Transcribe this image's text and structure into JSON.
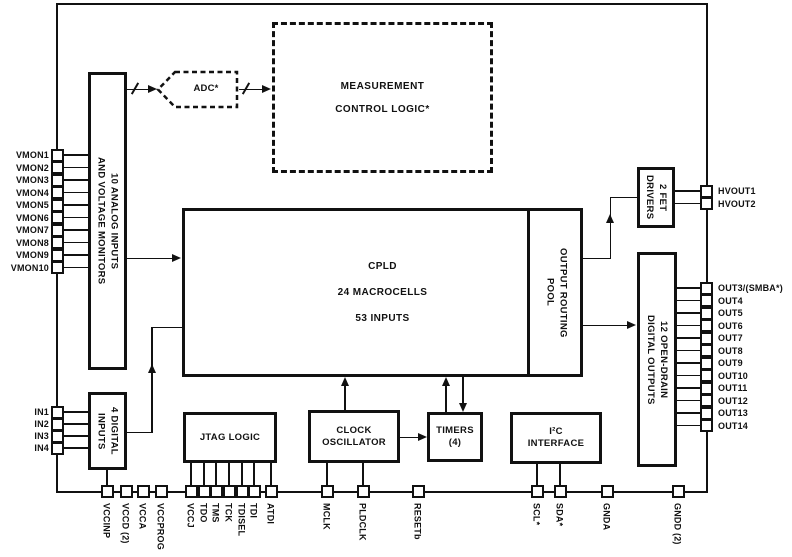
{
  "diagram": {
    "title": "CPLD supervisor functional block diagram",
    "blocks": {
      "analog_monitors": {
        "label": "10 ANALOG INPUTS\nAND VOLTAGE MONITORS"
      },
      "adc": {
        "label": "ADC*"
      },
      "measurement": {
        "label": "MEASUREMENT\nCONTROL LOGIC*"
      },
      "cpld": {
        "line1": "CPLD",
        "line2": "24 MACROCELLS",
        "line3": "53 INPUTS"
      },
      "output_routing_pool": {
        "label": "OUTPUT ROUTING\nPOOL"
      },
      "fet_drivers": {
        "label": "2 FET\nDRIVERS"
      },
      "digital_outputs": {
        "label": "12 OPEN-DRAIN\nDIGITAL OUTPUTS"
      },
      "digital_inputs": {
        "label": "4 DIGITAL\nINPUTS"
      },
      "jtag": {
        "label": "JTAG LOGIC"
      },
      "clock_oscillator": {
        "label": "CLOCK\nOSCILLATOR"
      },
      "timers": {
        "label": "TIMERS\n(4)"
      },
      "i2c": {
        "label": "I²C\nINTERFACE"
      }
    },
    "pins": {
      "vmon": [
        "VMON1",
        "VMON2",
        "VMON3",
        "VMON4",
        "VMON5",
        "VMON6",
        "VMON7",
        "VMON8",
        "VMON9",
        "VMON10"
      ],
      "digital_in": [
        "IN1",
        "IN2",
        "IN3",
        "IN4"
      ],
      "hvout": [
        "HVOUT1",
        "HVOUT2"
      ],
      "outputs": [
        "OUT3/(SMBA*)",
        "OUT4",
        "OUT5",
        "OUT6",
        "OUT7",
        "OUT8",
        "OUT9",
        "OUT10",
        "OUT11",
        "OUT12",
        "OUT13",
        "OUT14"
      ],
      "bottom": [
        "VCCINP",
        "VCCD (2)",
        "VCCA",
        "VCCPROG",
        "VCCJ",
        "TDO",
        "TMS",
        "TCK",
        "TDISEL",
        "TDI",
        "ATDI",
        "MCLK",
        "PLDCLK",
        "RESETb",
        "SCL*",
        "SDA*",
        "GNDA",
        "GNDD (2)"
      ]
    }
  }
}
